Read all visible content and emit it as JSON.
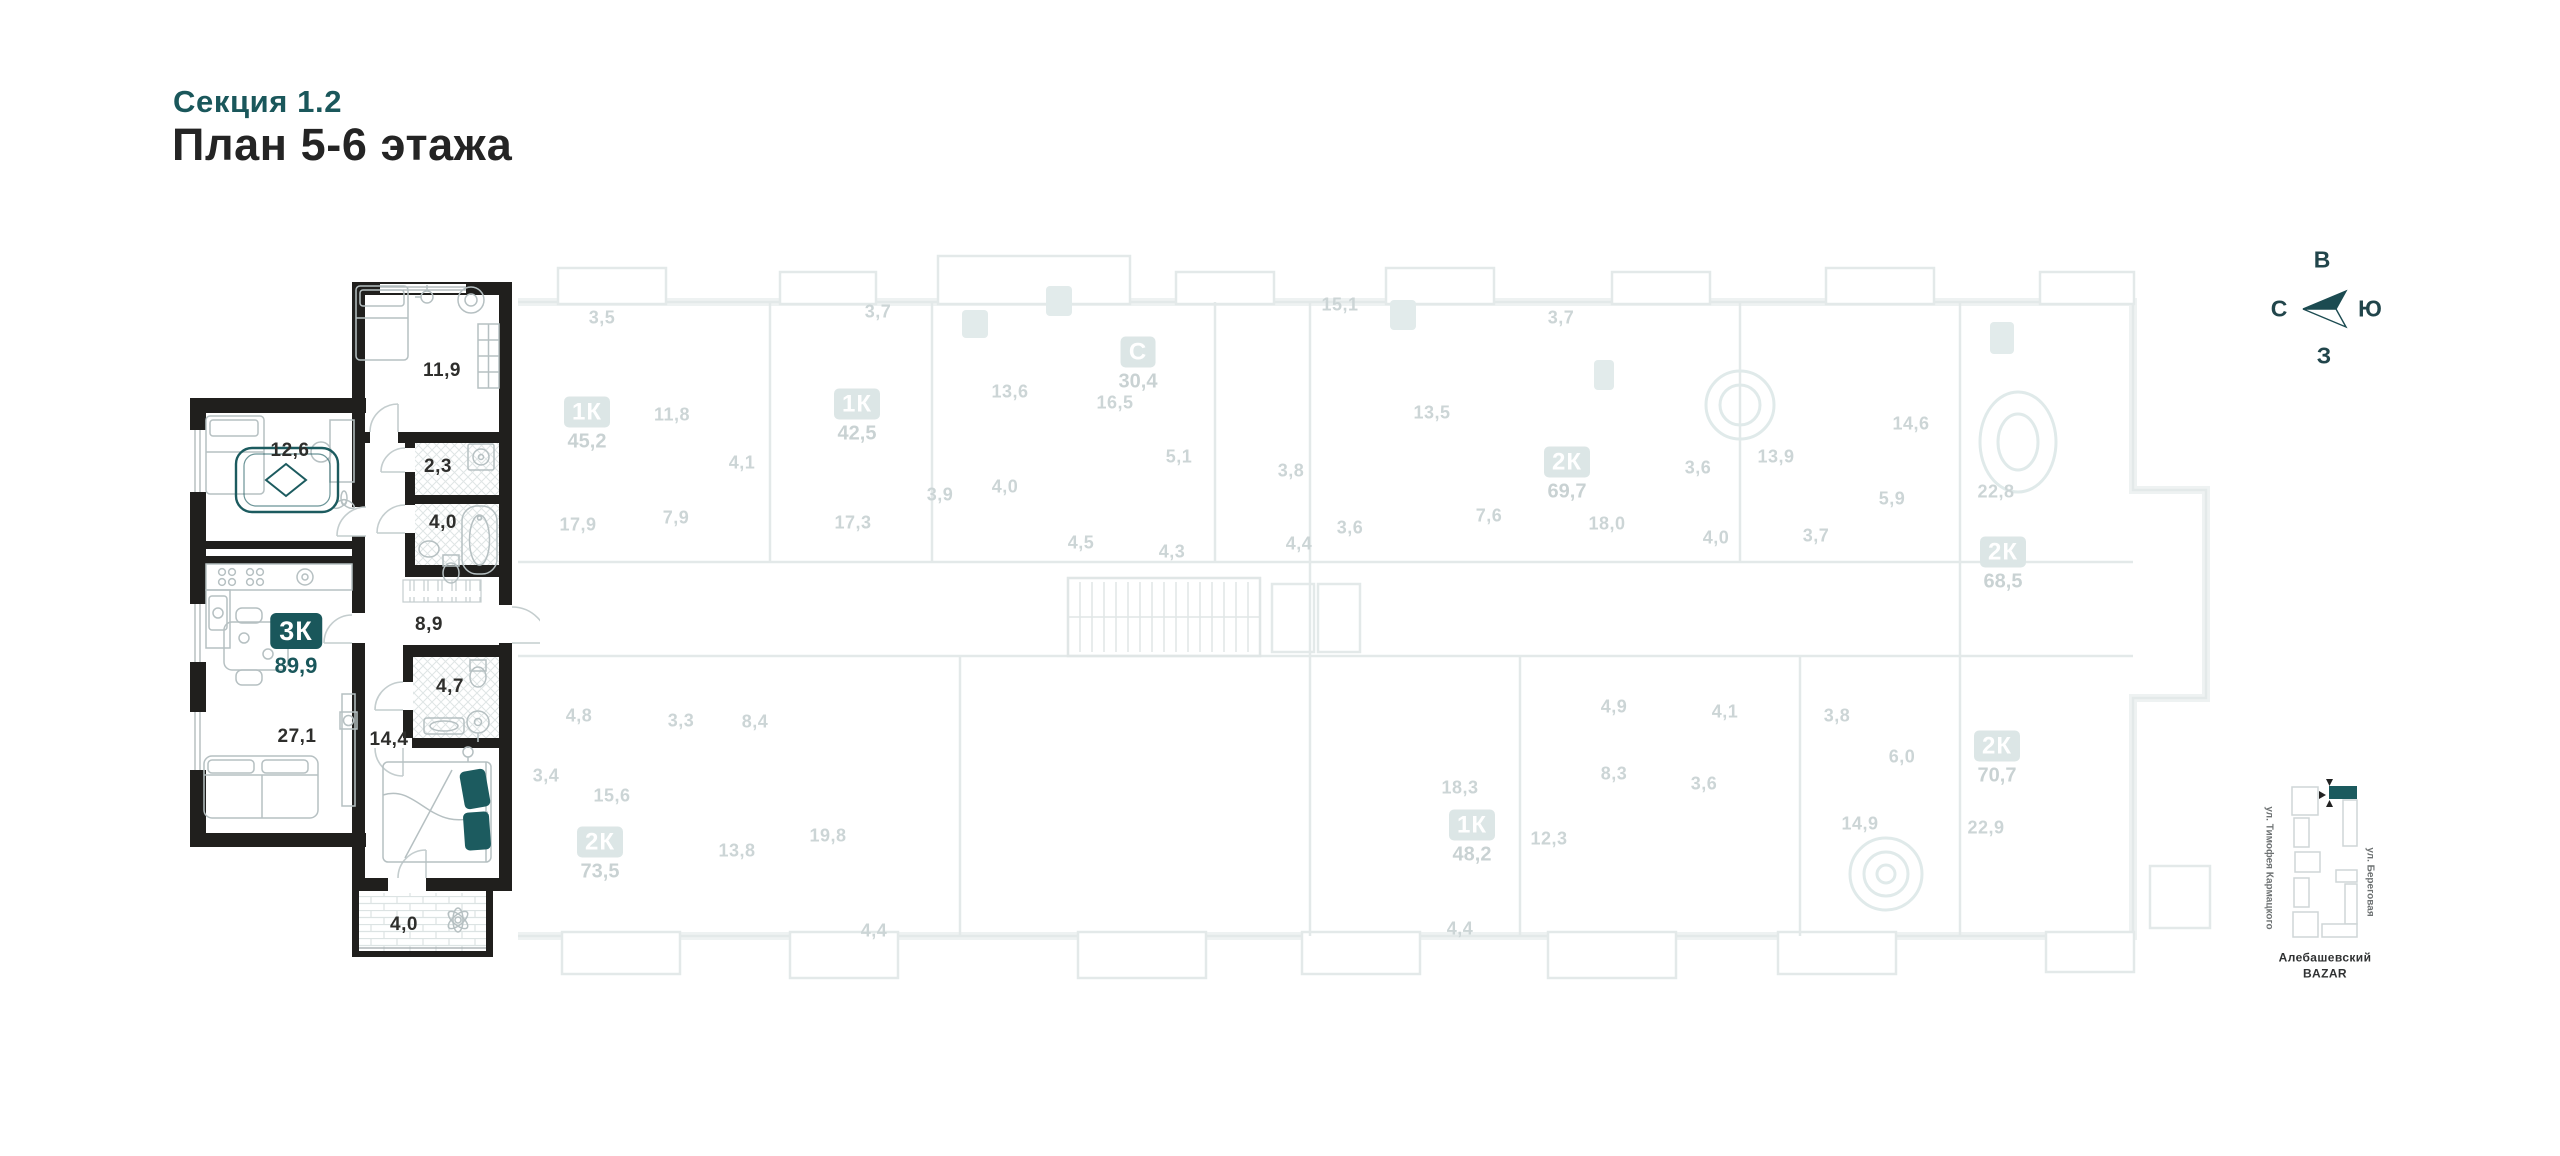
{
  "title": {
    "section": "Секция 1.2",
    "plan": "План 5-6 этажа"
  },
  "colors": {
    "accent_teal": "#1a575b",
    "wall_dark": "#201f1d",
    "faded_line": "#e3e9e9",
    "faded_text": "#ccd5d6",
    "faded_badge_bg": "#dce6e6",
    "furniture_stroke": "#b6c0c2"
  },
  "highlighted_apartment": {
    "unit": {
      "type": "3К",
      "area": "89,9",
      "badge_x": 296,
      "badge_y": 631
    },
    "rooms": [
      {
        "name": "bedroom-1",
        "area": "11,9",
        "x": 442,
        "y": 371
      },
      {
        "name": "bedroom-2",
        "area": "12,6",
        "x": 290,
        "y": 451
      },
      {
        "name": "wc",
        "area": "2,3",
        "x": 438,
        "y": 467
      },
      {
        "name": "bathroom-1",
        "area": "4,0",
        "x": 443,
        "y": 523
      },
      {
        "name": "hallway",
        "area": "8,9",
        "x": 429,
        "y": 625
      },
      {
        "name": "kitchen-living",
        "area": "27,1",
        "x": 297,
        "y": 737
      },
      {
        "name": "bedroom-3",
        "area": "14,4",
        "x": 389,
        "y": 740
      },
      {
        "name": "bathroom-2",
        "area": "4,7",
        "x": 450,
        "y": 687
      },
      {
        "name": "balcony",
        "area": "4,0",
        "x": 404,
        "y": 925
      }
    ]
  },
  "faded_units": [
    {
      "type": "1К",
      "area": "45,2",
      "x": 587,
      "y": 412
    },
    {
      "type": "1К",
      "area": "42,5",
      "x": 857,
      "y": 404
    },
    {
      "type": "С",
      "area": "30,4",
      "x": 1138,
      "y": 352
    },
    {
      "type": "2К",
      "area": "69,7",
      "x": 1567,
      "y": 462
    },
    {
      "type": "2К",
      "area": "68,5",
      "x": 2003,
      "y": 552
    },
    {
      "type": "2К",
      "area": "73,5",
      "x": 600,
      "y": 842
    },
    {
      "type": "1К",
      "area": "48,2",
      "x": 1472,
      "y": 825
    },
    {
      "type": "2К",
      "area": "70,7",
      "x": 1997,
      "y": 746
    }
  ],
  "faded_room_labels": [
    {
      "t": "3,5",
      "x": 602,
      "y": 318
    },
    {
      "t": "11,8",
      "x": 672,
      "y": 415
    },
    {
      "t": "4,1",
      "x": 742,
      "y": 463
    },
    {
      "t": "17,9",
      "x": 578,
      "y": 525
    },
    {
      "t": "7,9",
      "x": 676,
      "y": 518
    },
    {
      "t": "3,7",
      "x": 878,
      "y": 312
    },
    {
      "t": "13,6",
      "x": 1010,
      "y": 392
    },
    {
      "t": "3,9",
      "x": 940,
      "y": 495
    },
    {
      "t": "4,0",
      "x": 1005,
      "y": 487
    },
    {
      "t": "17,3",
      "x": 853,
      "y": 523
    },
    {
      "t": "16,5",
      "x": 1115,
      "y": 403
    },
    {
      "t": "5,1",
      "x": 1179,
      "y": 457
    },
    {
      "t": "4,5",
      "x": 1081,
      "y": 543
    },
    {
      "t": "4,3",
      "x": 1172,
      "y": 552
    },
    {
      "t": "15,1",
      "x": 1340,
      "y": 305
    },
    {
      "t": "3,8",
      "x": 1291,
      "y": 471
    },
    {
      "t": "4,4",
      "x": 1299,
      "y": 544
    },
    {
      "t": "13,5",
      "x": 1432,
      "y": 413
    },
    {
      "t": "3,7",
      "x": 1561,
      "y": 318
    },
    {
      "t": "7,6",
      "x": 1489,
      "y": 516
    },
    {
      "t": "3,6",
      "x": 1350,
      "y": 528
    },
    {
      "t": "18,0",
      "x": 1607,
      "y": 524
    },
    {
      "t": "3,6",
      "x": 1698,
      "y": 468
    },
    {
      "t": "4,0",
      "x": 1716,
      "y": 538
    },
    {
      "t": "13,9",
      "x": 1776,
      "y": 457
    },
    {
      "t": "14,6",
      "x": 1911,
      "y": 424
    },
    {
      "t": "5,9",
      "x": 1892,
      "y": 499
    },
    {
      "t": "3,7",
      "x": 1816,
      "y": 536
    },
    {
      "t": "22,8",
      "x": 1996,
      "y": 492
    },
    {
      "t": "4,8",
      "x": 579,
      "y": 716
    },
    {
      "t": "3,3",
      "x": 681,
      "y": 721
    },
    {
      "t": "8,4",
      "x": 755,
      "y": 722
    },
    {
      "t": "3,4",
      "x": 546,
      "y": 776
    },
    {
      "t": "15,6",
      "x": 612,
      "y": 796
    },
    {
      "t": "13,8",
      "x": 737,
      "y": 851
    },
    {
      "t": "19,8",
      "x": 828,
      "y": 836
    },
    {
      "t": "4,4",
      "x": 874,
      "y": 931
    },
    {
      "t": "18,3",
      "x": 1460,
      "y": 788
    },
    {
      "t": "4,9",
      "x": 1614,
      "y": 707
    },
    {
      "t": "4,1",
      "x": 1725,
      "y": 712
    },
    {
      "t": "8,3",
      "x": 1614,
      "y": 774
    },
    {
      "t": "3,6",
      "x": 1704,
      "y": 784
    },
    {
      "t": "12,3",
      "x": 1549,
      "y": 839
    },
    {
      "t": "4,4",
      "x": 1460,
      "y": 929
    },
    {
      "t": "3,8",
      "x": 1837,
      "y": 716
    },
    {
      "t": "6,0",
      "x": 1902,
      "y": 757
    },
    {
      "t": "14,9",
      "x": 1860,
      "y": 824
    },
    {
      "t": "22,9",
      "x": 1986,
      "y": 828
    }
  ],
  "compass": {
    "points": [
      {
        "t": "В",
        "x": 2322,
        "y": 260
      },
      {
        "t": "С",
        "x": 2279,
        "y": 309
      },
      {
        "t": "Ю",
        "x": 2370,
        "y": 309
      },
      {
        "t": "З",
        "x": 2324,
        "y": 356
      }
    ]
  },
  "minimap": {
    "street_left": "ул. Тимофея Кармацкого",
    "street_right": "ул. Береговая",
    "landmark_line1": "Алебашевский",
    "landmark_line2": "BAZAR"
  }
}
